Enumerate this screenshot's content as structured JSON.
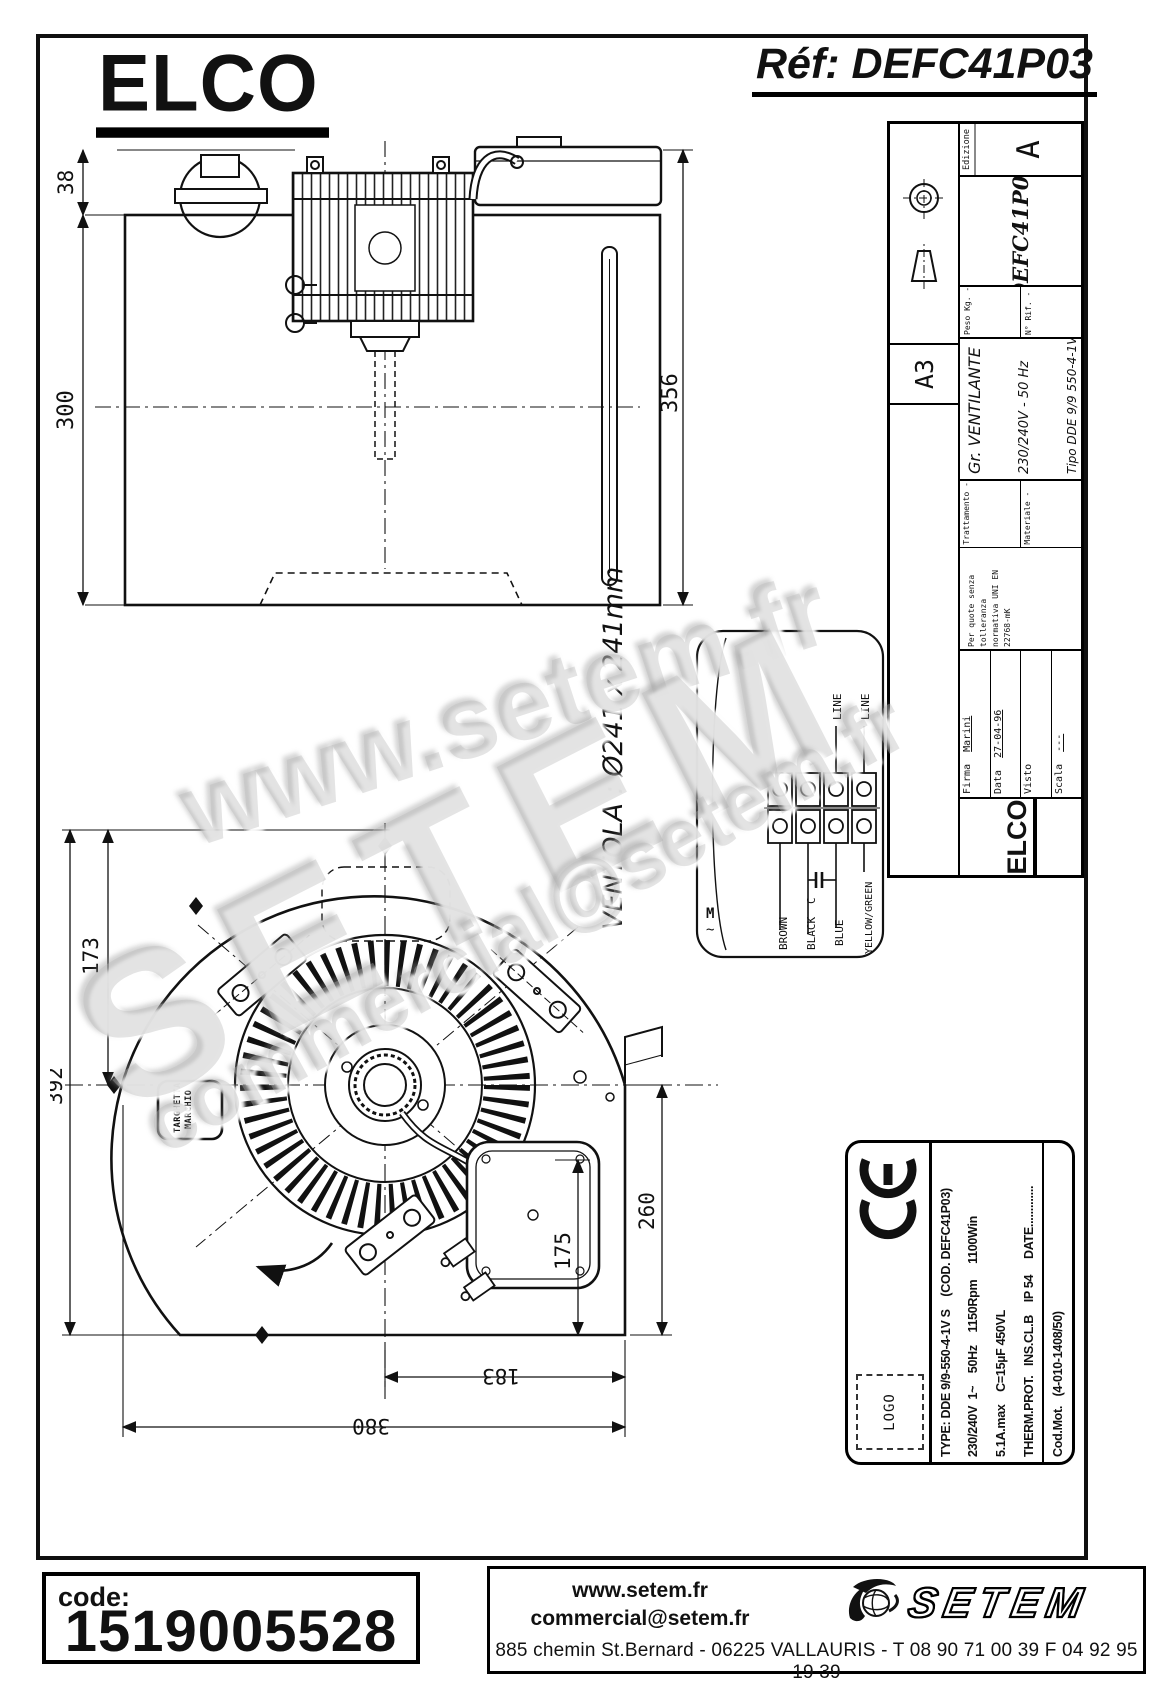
{
  "header": {
    "brand": "ELCO",
    "ref": "Réf: DEFC41P03"
  },
  "title_block": {
    "format": "A3",
    "edizione_label": "Edizione",
    "edizione_value": "A",
    "peso": "Peso Kg. -",
    "rif": "N° Rif. -",
    "code": "DEFC41P03",
    "group": "Gr. VENTILANTE",
    "supply": "230/240V - 50 Hz",
    "tipo": "Tipo DDE 9/9 550-4-1V S",
    "tol1": "Per quote senza tolleranza",
    "tol2": "normativa UNI EN 22768-mK",
    "trattamento": "Trattamento -",
    "materiale": "Materiale -",
    "firma_label": "Firma",
    "firma_value": "Marini",
    "data_label": "Data",
    "data_value": "27-04-96",
    "visto_label": "Visto",
    "visto_value": "",
    "scala_label": "Scala",
    "scala_value": "---",
    "brand": "ELCO"
  },
  "front_view": {
    "dim_38": "38",
    "dim_300": "300",
    "dim_356": "356"
  },
  "fan_note": "VENTOLA : Ø241 x 241mm",
  "wiring": {
    "line_a": "LINE",
    "line_b": "LINE",
    "cap": "C",
    "motor": "M",
    "motor_wave": "~",
    "wire_brown": "BROWN",
    "wire_black": "BLACK",
    "wire_blue": "BLUE",
    "wire_yg": "YELLOW/GREEN"
  },
  "side_view": {
    "dim_173": "173",
    "dim_392": "392",
    "dim_260": "260",
    "dim_175": "175",
    "dim_183": "183",
    "dim_380": "380",
    "targhetta_1": "TARGHETTA",
    "targhetta_2": "MARCHIO"
  },
  "plate": {
    "logo": "LOGO",
    "row_type": "TYPE: DDE 9/9-550-4-1V S    (COD. DEFC41P03)",
    "row_elec": "230/240V  1~    50Hz    1150Rpm     1100Win",
    "row_cap": "5.1A.max    C=15µF 450VL",
    "row_prot": "THERM.PROT.   INS.CL.B    IP 54     DATE.............",
    "row_mot": "Cod.Mot.   (4-010-1408/50)"
  },
  "footer": {
    "code_label": "code:",
    "code_value": "1519005528",
    "website": "www.setem.fr",
    "email": "commercial@setem.fr",
    "address": "885 chemin St.Bernard  -  06225 VALLAURIS  -  T 08 90 71 00 39   F 04 92 95 19 39",
    "brand": "SETEM"
  },
  "watermark": {
    "top": "www.setem.fr",
    "middle": "SETEM",
    "bottom": "commercial@setem.fr"
  }
}
